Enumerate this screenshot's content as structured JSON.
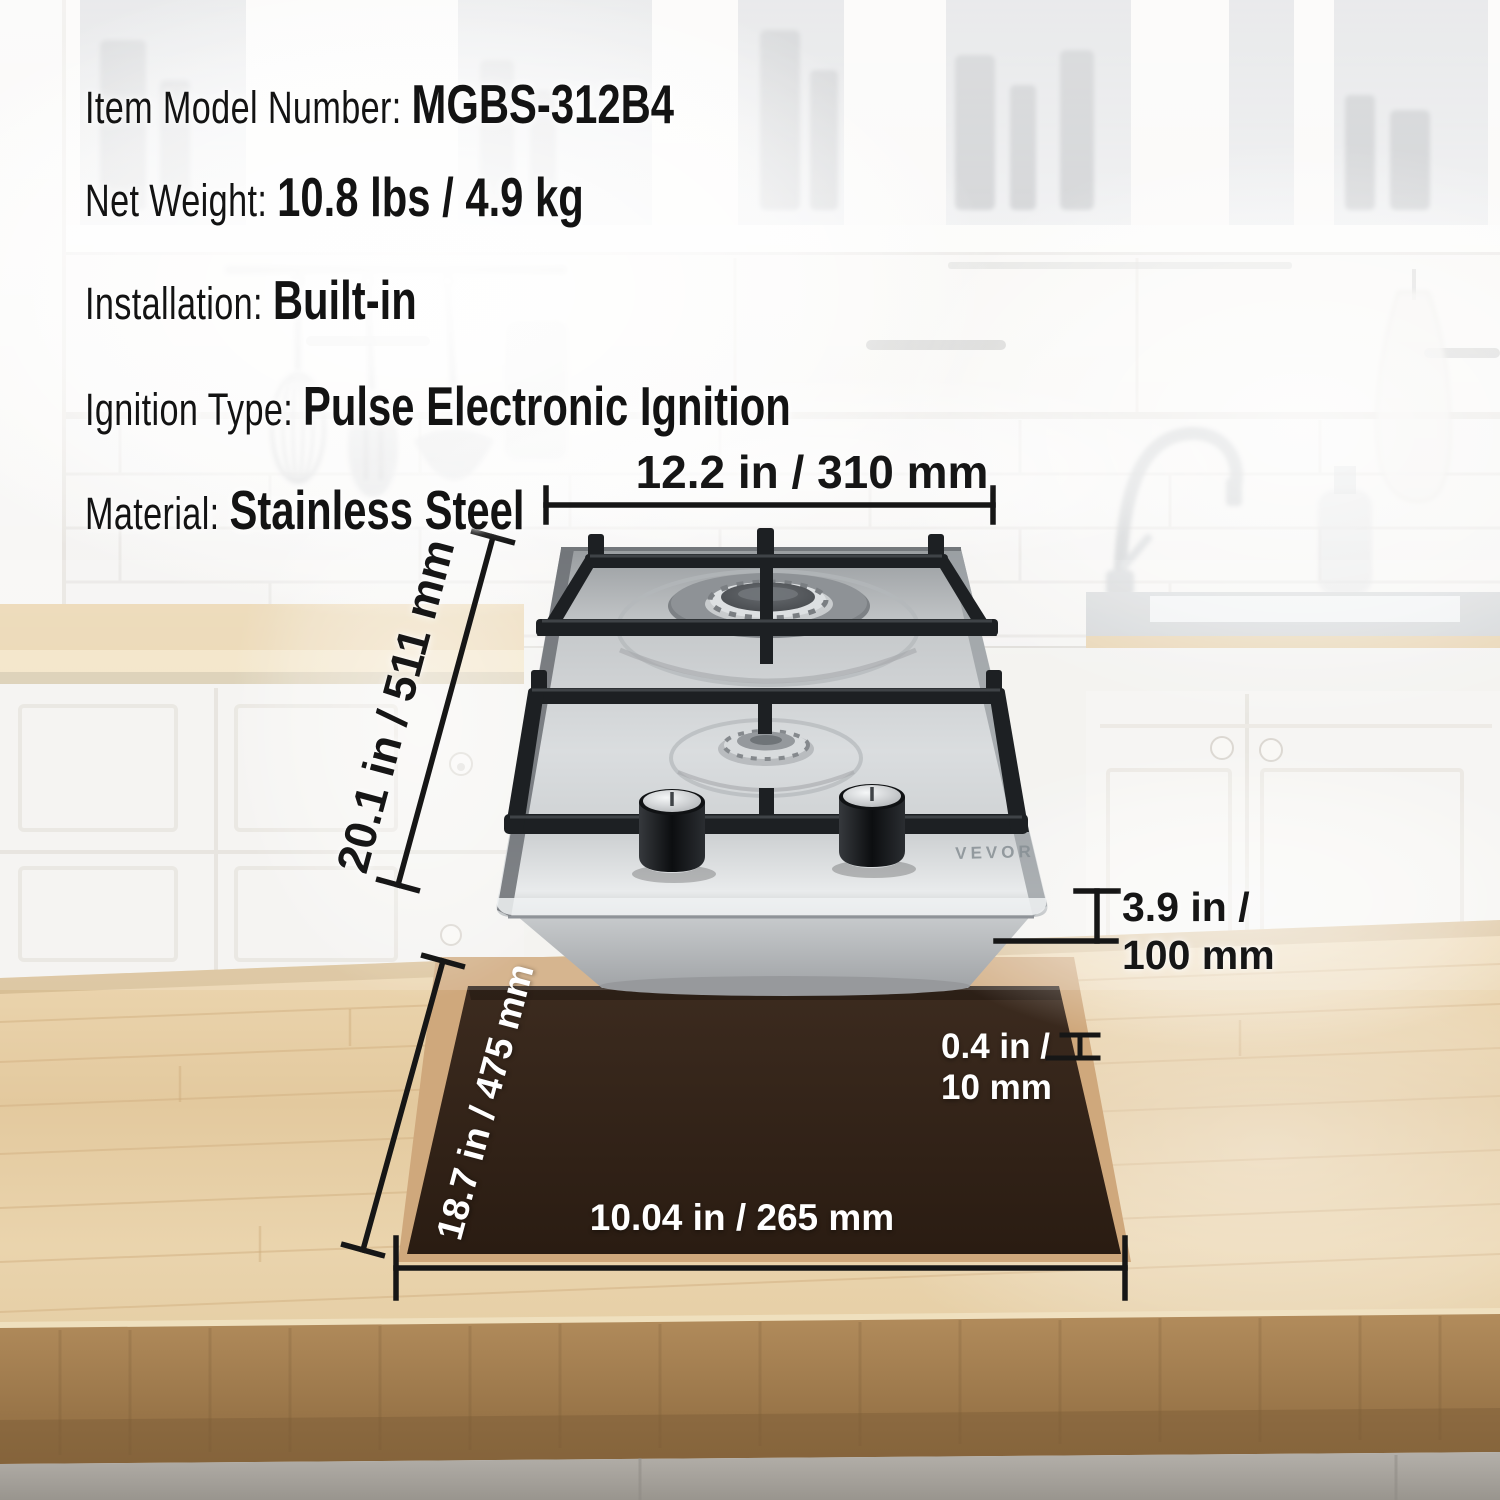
{
  "product": {
    "brand": "VEVOR",
    "specs": [
      {
        "label": "Item Model Number:",
        "value": "MGBS-312B4"
      },
      {
        "label": "Net Weight:",
        "value": "10.8 lbs / 4.9 kg"
      },
      {
        "label": "Installation:",
        "value": "Built-in"
      },
      {
        "label": "Ignition Type:",
        "value": "Pulse Electronic Ignition"
      },
      {
        "label": "Material:",
        "value": "Stainless Steel"
      }
    ]
  },
  "dimensions": {
    "cooktop_width": "12.2 in / 310 mm",
    "cooktop_depth": "20.1 in / 511 mm",
    "cooktop_height": "3.9 in /\n100 mm",
    "cutout_thickness": "0.4 in /\n10 mm",
    "cutout_depth": "18.7 in / 475 mm",
    "cutout_width": "10.04 in / 265 mm"
  },
  "colors": {
    "annotation_dark": "#161616",
    "annotation_light": "#ffffff",
    "cutout_fill": "#2e1f15",
    "cutout_rim": "#cfa87c",
    "steel": "#d6d9db",
    "wood_top": "#e6cfa6"
  }
}
